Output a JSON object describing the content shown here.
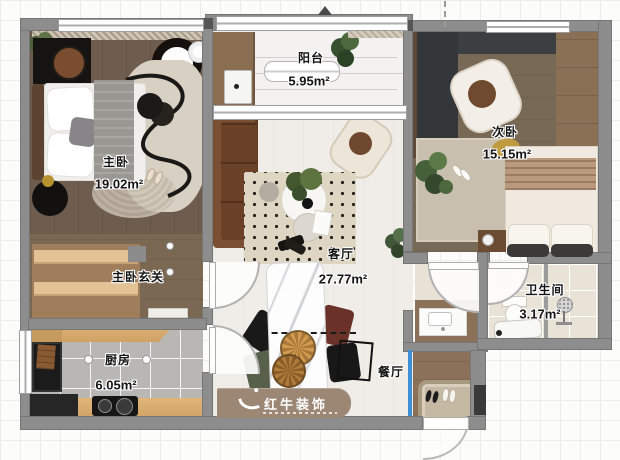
{
  "watermark": {
    "brand": "红牛装饰"
  },
  "rooms": {
    "master_bedroom": {
      "name": "主卧",
      "area": "19.02m²"
    },
    "master_hall": {
      "name": "主卧玄关"
    },
    "balcony": {
      "name": "阳台",
      "area": "5.95m²"
    },
    "second_bedroom": {
      "name": "次卧",
      "area": "15.15m²"
    },
    "living_room": {
      "name": "客厅",
      "area": "27.77m²"
    },
    "dining_room": {
      "name": "餐厅"
    },
    "kitchen": {
      "name": "厨房",
      "area": "6.05m²"
    },
    "bathroom": {
      "name": "卫生间",
      "area": "3.17m²"
    }
  },
  "colors": {
    "wall_gray": "#8d8d8d",
    "glass_partition_blue": "#3f8fd6",
    "master_floor_wood": "#6e5d4e",
    "second_bedroom_floor_wood": "#786957",
    "kitchen_tile_gray": "#b8b7b4",
    "bathroom_tile_beige": "#eae4d9",
    "watermark_panel_brown": "#9c8775"
  }
}
